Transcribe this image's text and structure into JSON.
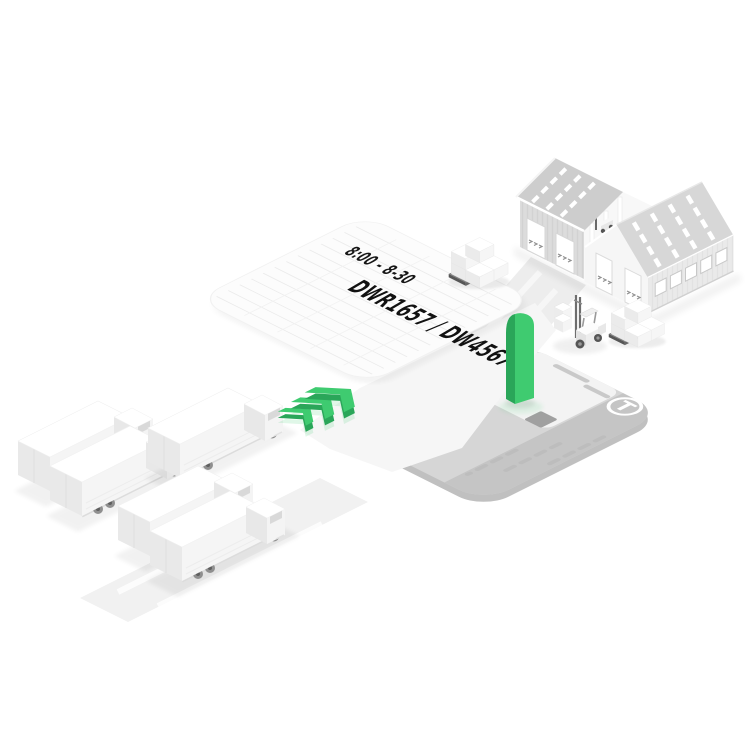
{
  "scene": {
    "background": "#ffffff",
    "labels": {
      "time_slot": "8:00 - 8-30",
      "dock_assignment": "DWR1657 / DW45676"
    },
    "brand_logo_letter": "T",
    "colors": {
      "accent_green": "#3FCB70",
      "accent_green_dark": "#2AA659",
      "pad_gray": "#D6D6D6",
      "pad_gray_dark": "#C5C5C5"
    },
    "objects": {
      "trucks_waiting": 5,
      "direction_chevrons": 3,
      "icons": [
        "warehouse-icon",
        "truck-icon",
        "forklift-icon",
        "pallet-stack-icon",
        "gate-pillar-icon",
        "chevron-arrows-icon",
        "schedule-sheet-icon",
        "dock-pad-icon",
        "brand-badge-icon"
      ]
    }
  }
}
